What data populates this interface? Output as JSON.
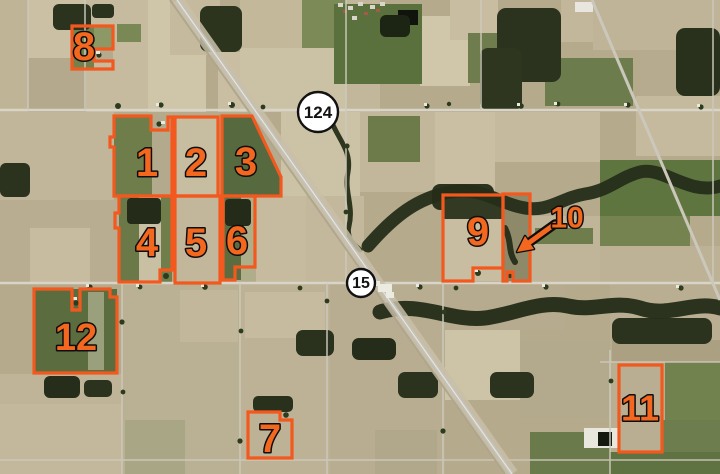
{
  "map": {
    "type": "aerial-parcel-map",
    "description": "satellite farmland view with numbered field boundaries",
    "colors": {
      "parcel_stroke": "#f3591e",
      "label_fill": "#f4671f",
      "label_outline": "#0e0e0e",
      "shield_fill": "#ffffff",
      "shield_ring": "#121212",
      "shield_text": "#121212"
    }
  },
  "parcels": [
    {
      "id": "1",
      "points": "114,116 151,116 151,130 168,130 168,117 172,117 172,196 114,196 114,147 110,147 110,137 114,137",
      "label": {
        "text": "1",
        "x": 147,
        "y": 163,
        "size": 40
      }
    },
    {
      "id": "2",
      "points": "175,117 218,117 218,196 175,196",
      "label": {
        "text": "2",
        "x": 196,
        "y": 163,
        "size": 40
      }
    },
    {
      "id": "3",
      "points": "222,116 252,116 281,177 281,196 222,196",
      "label": {
        "text": "3",
        "x": 246,
        "y": 162,
        "size": 40
      }
    },
    {
      "id": "4",
      "points": "119,196 172,196 172,270 160,270 160,282 119,282 119,228 115,228 115,213 119,213",
      "label": {
        "text": "4",
        "x": 147,
        "y": 243,
        "size": 40
      }
    },
    {
      "id": "5",
      "points": "175,196 220,196 220,283 175,283",
      "label": {
        "text": "5",
        "x": 196,
        "y": 243,
        "size": 40
      }
    },
    {
      "id": "6",
      "points": "223,196 255,196 255,267 235,267 235,280 223,280",
      "label": {
        "text": "6",
        "x": 237,
        "y": 241,
        "size": 40
      }
    },
    {
      "id": "7",
      "points": "248,412 280,412 280,420 292,420 292,458 248,458",
      "label": {
        "text": "7",
        "x": 270,
        "y": 439,
        "size": 40
      }
    },
    {
      "id": "8",
      "points": "72,26 113,26 113,49 94,49 94,61 113,61 113,69 72,69",
      "label": {
        "text": "8",
        "x": 84,
        "y": 47,
        "size": 40
      }
    },
    {
      "id": "9",
      "points": "443,195 503,195 503,268 473,268 473,281 443,281",
      "label": {
        "text": "9",
        "x": 478,
        "y": 232,
        "size": 40
      }
    },
    {
      "id": "10",
      "points": "503,194 530,194 530,281 513,281 513,272 507,272 507,281 503,281",
      "label": {
        "text": "10",
        "x": 567,
        "y": 218,
        "size": 30
      }
    },
    {
      "id": "11",
      "points": "619,365 662,365 662,452 619,452",
      "label": {
        "text": "11",
        "x": 640,
        "y": 408,
        "size": 36
      }
    },
    {
      "id": "12",
      "points": "34,289 72,289 72,310 80,310 80,289 110,289 110,297 117,297 117,373 34,373",
      "label": {
        "text": "12",
        "x": 76,
        "y": 338,
        "size": 38
      }
    }
  ],
  "callout_arrow": {
    "target_parcel": "10",
    "shaft": {
      "x1": 555,
      "y1": 224,
      "x2": 530,
      "y2": 242
    },
    "head_points": "517,252 525,236 534,249"
  },
  "route_shields": [
    {
      "text": "124",
      "cx": 318,
      "cy": 112,
      "r": 20,
      "font": 17
    },
    {
      "text": "15",
      "cx": 361,
      "cy": 283,
      "r": 14,
      "font": 16
    }
  ]
}
